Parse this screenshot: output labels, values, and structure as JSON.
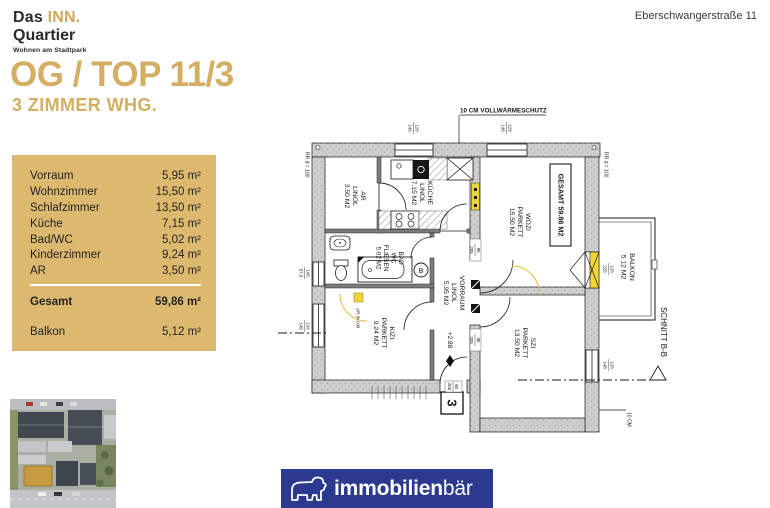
{
  "colors": {
    "gold": "#d4ae63",
    "gold_box": "#dcb96e",
    "navy": "#2b3a8e",
    "ink": "#242424",
    "wall_gray": "#cfcfcf",
    "plan_yellow": "#f3d435"
  },
  "header": {
    "logo": {
      "das": "Das ",
      "inn": "INN.",
      "quartier": "Quartier",
      "tagline": "Wohnen am Stadtpark"
    },
    "address": "Eberschwangerstraße 11"
  },
  "title": "OG / TOP 11/3",
  "subtitle": "3 ZIMMER WHG.",
  "area_table": {
    "rows": [
      {
        "label": "Vorraum",
        "value": "5,95 m²"
      },
      {
        "label": "Wohnzimmer",
        "value": "15,50 m²"
      },
      {
        "label": "Schlafzimmer",
        "value": "13,50 m²"
      },
      {
        "label": "Küche",
        "value": "7,15 m²"
      },
      {
        "label": "Bad/WC",
        "value": "5,02 m²"
      },
      {
        "label": "Kinderzimmer",
        "value": "9,24 m²"
      },
      {
        "label": "AR",
        "value": "3,50 m²"
      }
    ],
    "total": {
      "label": "Gesamt",
      "value": "59,86 m²"
    },
    "balkon": {
      "label": "Balkon",
      "value": "5,12 m²"
    }
  },
  "floorplan": {
    "insulation_top": "10 CM VOLLWÄRMESCHUTZ",
    "insulation_bottom": "10 CM",
    "rr_left": "RR d = 100",
    "rr_right": "RR d = 100",
    "gesamt_box": "GESAMT 59.86 M2",
    "level": "+2.88",
    "schnitt": "SCHNITT B-B",
    "unit_number": "3",
    "duct": "AR d=100",
    "boiler": "B",
    "rooms": {
      "ar": [
        "AR",
        "LINOL",
        "3.50 M2"
      ],
      "kueche": [
        "KÜCHE",
        "LINOL",
        "7.15 M2"
      ],
      "wozi": [
        "WOZI",
        "PARKETT",
        "15.50 M2"
      ],
      "bad": [
        "BAD",
        "WC",
        "FLIESEN",
        "5.02 M2"
      ],
      "vorraum": [
        "VORRAUM",
        "LINOL",
        "5.95 M2"
      ],
      "kizi": [
        "KIZI",
        "PARKETT",
        "9.24 M2"
      ],
      "szi": [
        "SZI",
        "PARKETT",
        "13.50 M2"
      ],
      "balkon": [
        "BALKON",
        "5.12 M2"
      ]
    },
    "dims": {
      "top_window_left": [
        "128",
        "148"
      ],
      "top_window_right": [
        "128",
        "148"
      ],
      "wall_left_upper": [
        "145",
        "57,5"
      ],
      "wall_left_lower": [
        "126",
        "145"
      ],
      "szi_window": [
        "128",
        "148"
      ],
      "balcony_door": [
        "128",
        "225"
      ],
      "door_upper": [
        "90",
        "205"
      ],
      "door_lower": [
        "90",
        "205"
      ],
      "entrance_door": [
        "80",
        "205"
      ]
    }
  },
  "footer": {
    "brand_bold": "immobilien",
    "brand_light": "bär"
  }
}
